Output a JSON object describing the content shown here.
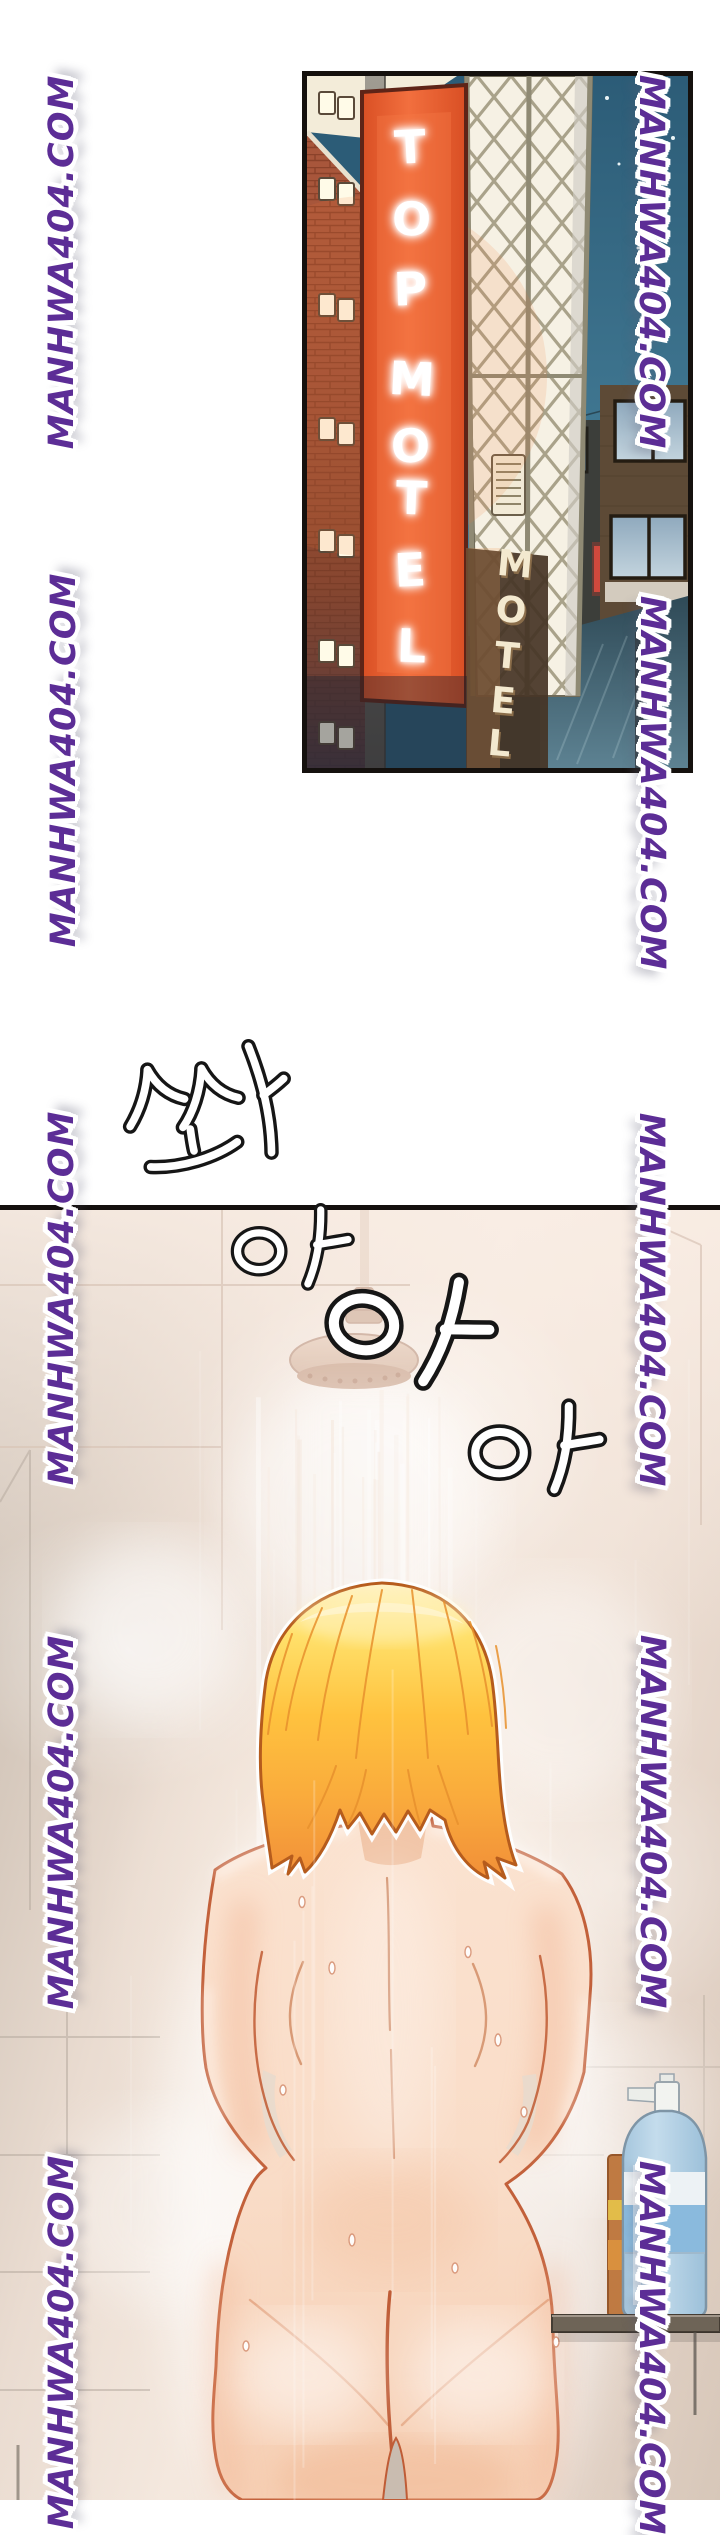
{
  "page": {
    "type": "webtoon-comic-page",
    "background": "#ffffff"
  },
  "watermark": {
    "text": "MANHWA404.COM",
    "color": "#5c2d96",
    "count": 10
  },
  "motel_panel": {
    "label": "night exterior with vertical TOP MOTEL neon sign",
    "main_sign_text": "TOP MOTEL",
    "main_sign_letters": [
      "T",
      "O",
      "P",
      "M",
      "O",
      "T",
      "E",
      "L"
    ],
    "small_sign_text": "MOTEL",
    "small_sign_letters": [
      "M",
      "O",
      "T",
      "E",
      "L"
    ],
    "colors": {
      "sign": "#e6552c",
      "sign_border": "#5e2417",
      "brick": "#a8563b",
      "sky_top": "#2c5c77",
      "sky_bottom": "#4b86a0",
      "cloud": "#7fa9b0"
    }
  },
  "shower_panel": {
    "label": "person showering seen from behind under running water",
    "sfx": [
      "쏴",
      "아",
      "아",
      "아"
    ],
    "colors": {
      "wall": "#f2e5dc",
      "wall_gray": "#c9beb3",
      "hair": "#ffc23e",
      "skin": "#f9dcc7",
      "outline": "#c2603a",
      "bottle_blue": "#b5d2e6",
      "shelf": "#6e6457"
    }
  }
}
